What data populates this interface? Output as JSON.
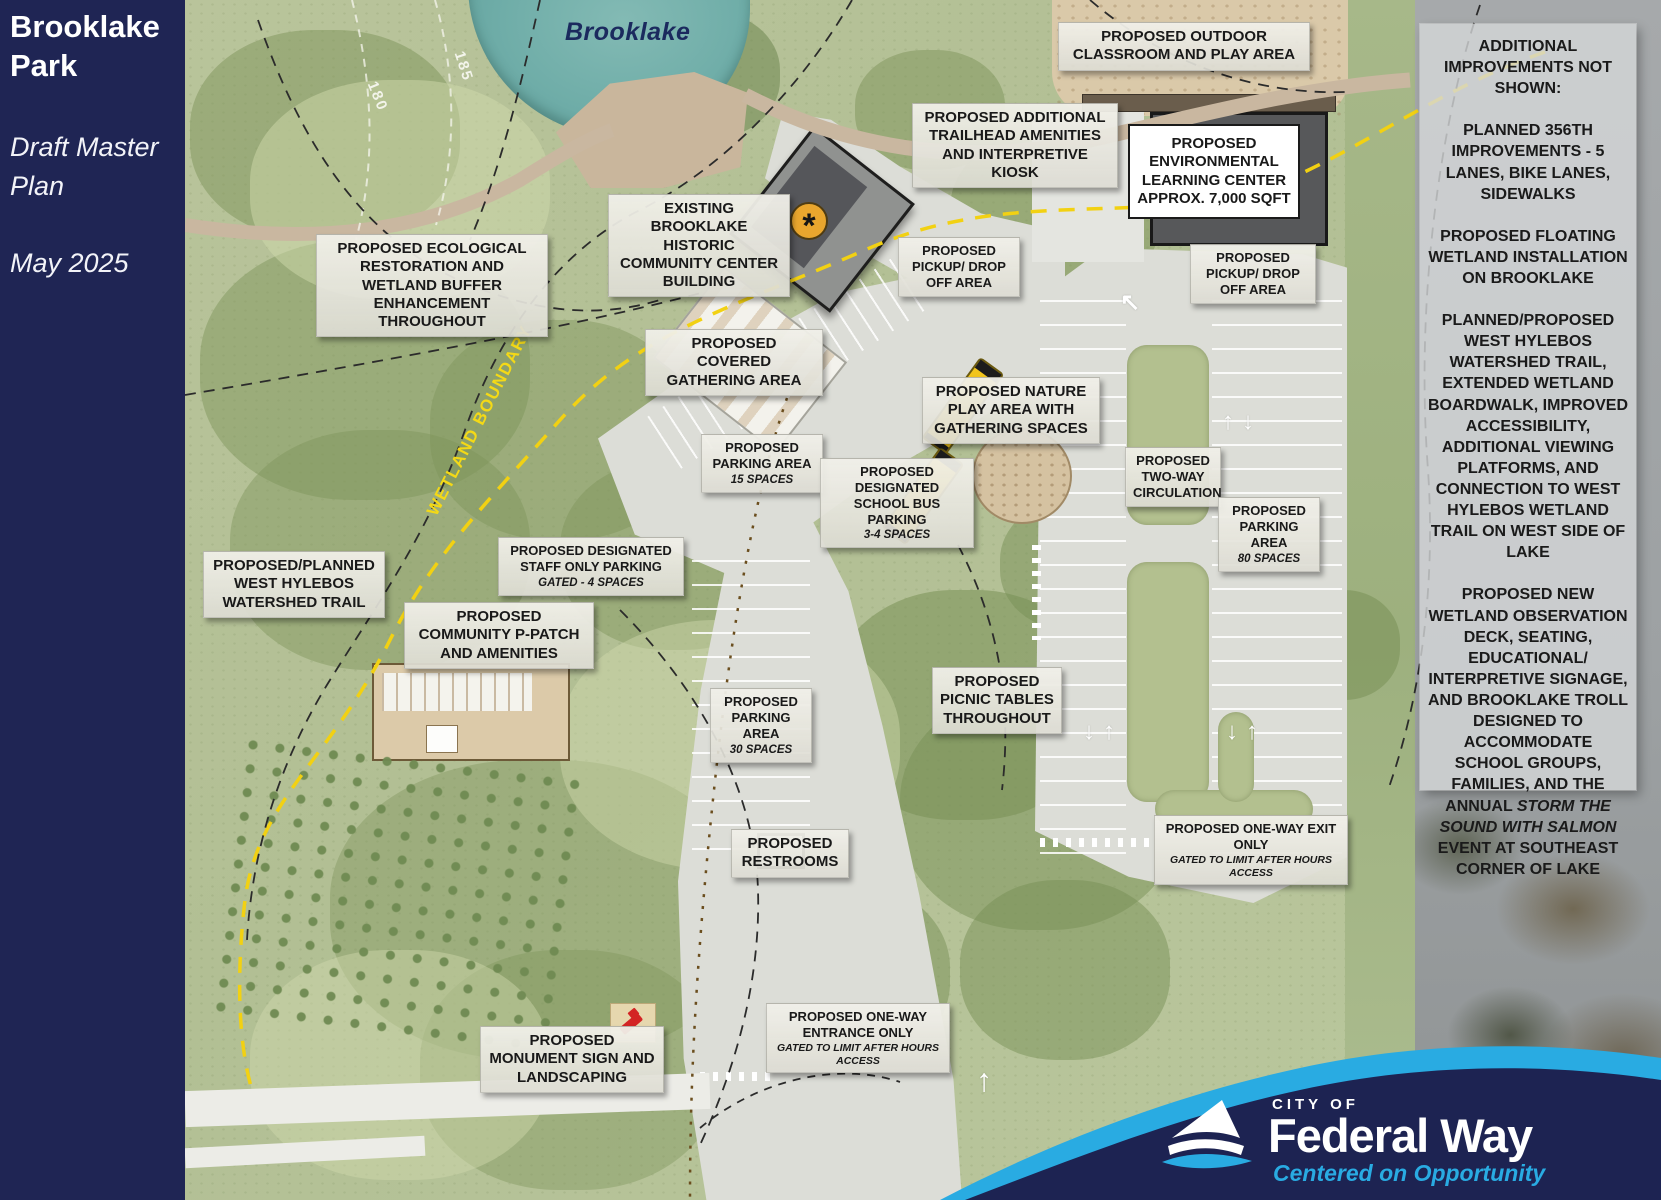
{
  "title_panel": {
    "title": "Brooklake Park",
    "subtitle": "Draft Master Plan",
    "date": "May 2025"
  },
  "map": {
    "lake_label": "Brooklake",
    "wetland_boundary_label": "WETLAND BOUNDARY",
    "contour_labels": [
      "185",
      "180"
    ],
    "labels": [
      {
        "id": "outdoor-classroom",
        "text": "PROPOSED OUTDOOR CLASSROOM AND PLAY AREA"
      },
      {
        "id": "trailhead-amenities",
        "text": "PROPOSED ADDITIONAL TRAILHEAD AMENITIES AND INTERPRETIVE KIOSK"
      },
      {
        "id": "environmental-learning-center",
        "text": "PROPOSED ENVIRONMENTAL LEARNING CENTER APPROX. 7,000 SQFT"
      },
      {
        "id": "existing-community-center",
        "text": "EXISTING BROOKLAKE HISTORIC COMMUNITY CENTER BUILDING"
      },
      {
        "id": "pickup-dropoff-west",
        "text": "PROPOSED PICKUP/ DROP OFF AREA"
      },
      {
        "id": "pickup-dropoff-east",
        "text": "PROPOSED PICKUP/ DROP OFF AREA"
      },
      {
        "id": "ecological-restoration",
        "text": "PROPOSED ECOLOGICAL RESTORATION AND WETLAND BUFFER ENHANCEMENT THROUGHOUT"
      },
      {
        "id": "covered-gathering",
        "text": "PROPOSED COVERED GATHERING AREA"
      },
      {
        "id": "nature-play",
        "text": "PROPOSED NATURE PLAY AREA WITH GATHERING SPACES"
      },
      {
        "id": "parking-15",
        "text": "PROPOSED PARKING AREA",
        "note": "15 SPACES"
      },
      {
        "id": "school-bus-parking",
        "text": "PROPOSED DESIGNATED SCHOOL BUS PARKING",
        "note": "3-4 SPACES"
      },
      {
        "id": "two-way-circulation",
        "text": "PROPOSED TWO-WAY CIRCULATION"
      },
      {
        "id": "parking-80",
        "text": "PROPOSED PARKING AREA",
        "note": "80 SPACES"
      },
      {
        "id": "west-hylebos-trail",
        "text": "PROPOSED/PLANNED WEST HYLEBOS WATERSHED TRAIL"
      },
      {
        "id": "staff-parking",
        "text": "PROPOSED DESIGNATED STAFF ONLY PARKING",
        "note": "GATED - 4 SPACES"
      },
      {
        "id": "community-p-patch",
        "text": "PROPOSED COMMUNITY P-PATCH AND AMENITIES"
      },
      {
        "id": "parking-30",
        "text": "PROPOSED PARKING AREA",
        "note": "30 SPACES"
      },
      {
        "id": "picnic-tables",
        "text": "PROPOSED PICNIC TABLES THROUGHOUT"
      },
      {
        "id": "restrooms",
        "text": "PROPOSED RESTROOMS"
      },
      {
        "id": "one-way-exit",
        "text": "PROPOSED ONE-WAY EXIT ONLY",
        "note": "GATED TO LIMIT AFTER HOURS ACCESS"
      },
      {
        "id": "one-way-entrance",
        "text": "PROPOSED ONE-WAY ENTRANCE ONLY",
        "note": "GATED TO LIMIT AFTER HOURS ACCESS"
      },
      {
        "id": "monument-sign",
        "text": "PROPOSED MONUMENT SIGN AND LANDSCAPING"
      }
    ]
  },
  "side_panel": {
    "title": "ADDITIONAL IMPROVEMENTS NOT SHOWN:",
    "paragraphs": [
      [
        {
          "t": "PLANNED 356TH IMPROVEMENTS - 5 LANES, BIKE LANES, SIDEWALKS"
        }
      ],
      [
        {
          "t": "PROPOSED FLOATING WETLAND INSTALLATION ON BROOKLAKE"
        }
      ],
      [
        {
          "t": "PLANNED/PROPOSED WEST HYLEBOS WATERSHED TRAIL, EXTENDED WETLAND BOARDWALK, IMPROVED ACCESSIBILITY, ADDITIONAL VIEWING PLATFORMS, AND CONNECTION TO WEST HYLEBOS WETLAND TRAIL ON WEST SIDE OF LAKE"
        }
      ],
      [
        {
          "t": "PROPOSED NEW WETLAND OBSERVATION DECK, SEATING, EDUCATIONAL/ INTERPRETIVE SIGNAGE, AND BROOKLAKE TROLL DESIGNED TO ACCOMMODATE SCHOOL GROUPS, FAMILIES, AND THE ANNUAL "
        },
        {
          "t": "STORM THE SOUND WITH SALMON",
          "italic": true
        },
        {
          "t": " EVENT AT SOUTHEAST CORNER OF LAKE"
        }
      ]
    ]
  },
  "footer_logo": {
    "city_of": "CITY OF",
    "name": "Federal Way",
    "tagline": "Centered on Opportunity"
  },
  "colors": {
    "navy": "#1f2554",
    "cyan": "#29abe2",
    "wetland_yellow": "#f2d411",
    "label_bg": "#e9e8e0"
  }
}
